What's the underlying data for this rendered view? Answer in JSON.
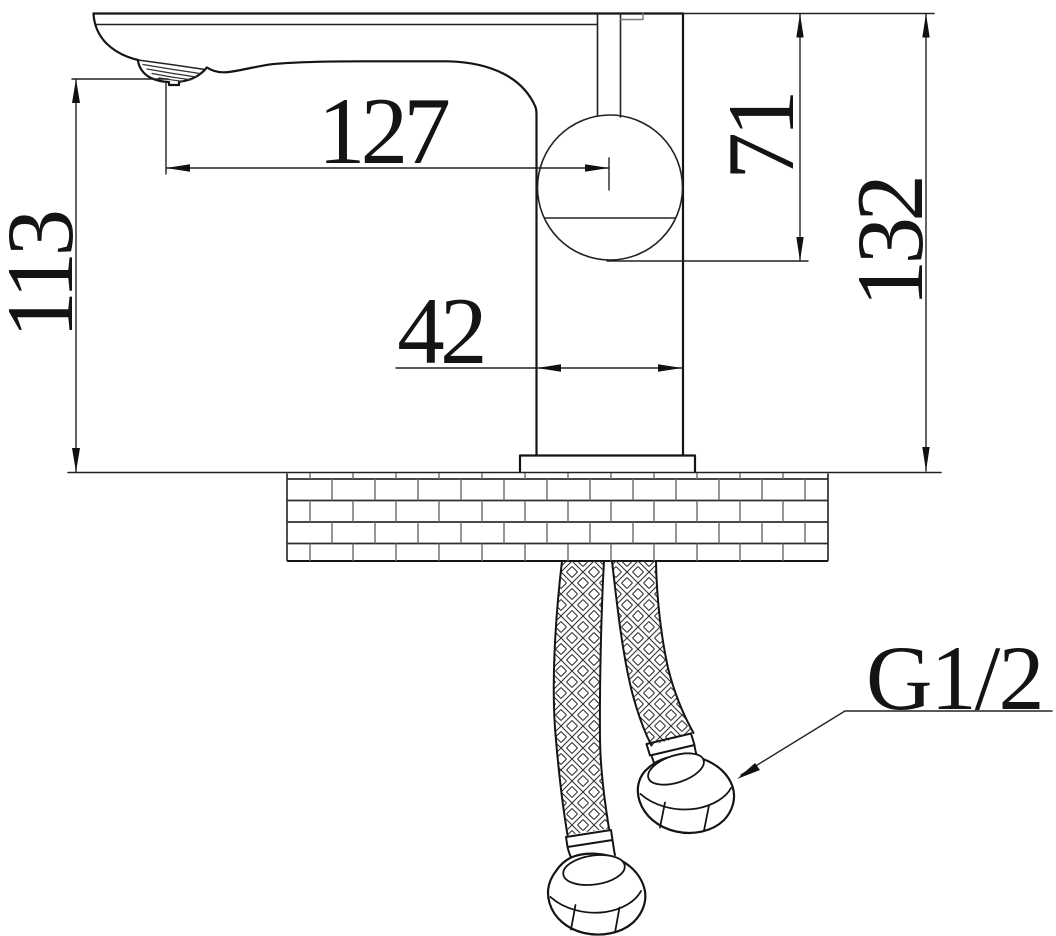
{
  "drawing": {
    "dimensions": {
      "spout_outlet_height": {
        "label": "113"
      },
      "spout_reach": {
        "label": "127"
      },
      "body_depth": {
        "label": "42"
      },
      "handle_height": {
        "label": "71"
      },
      "total_height": {
        "label": "132"
      }
    },
    "thread": {
      "label": "G1/2"
    },
    "colors": {
      "line": "#141414",
      "background": "#ffffff"
    }
  }
}
